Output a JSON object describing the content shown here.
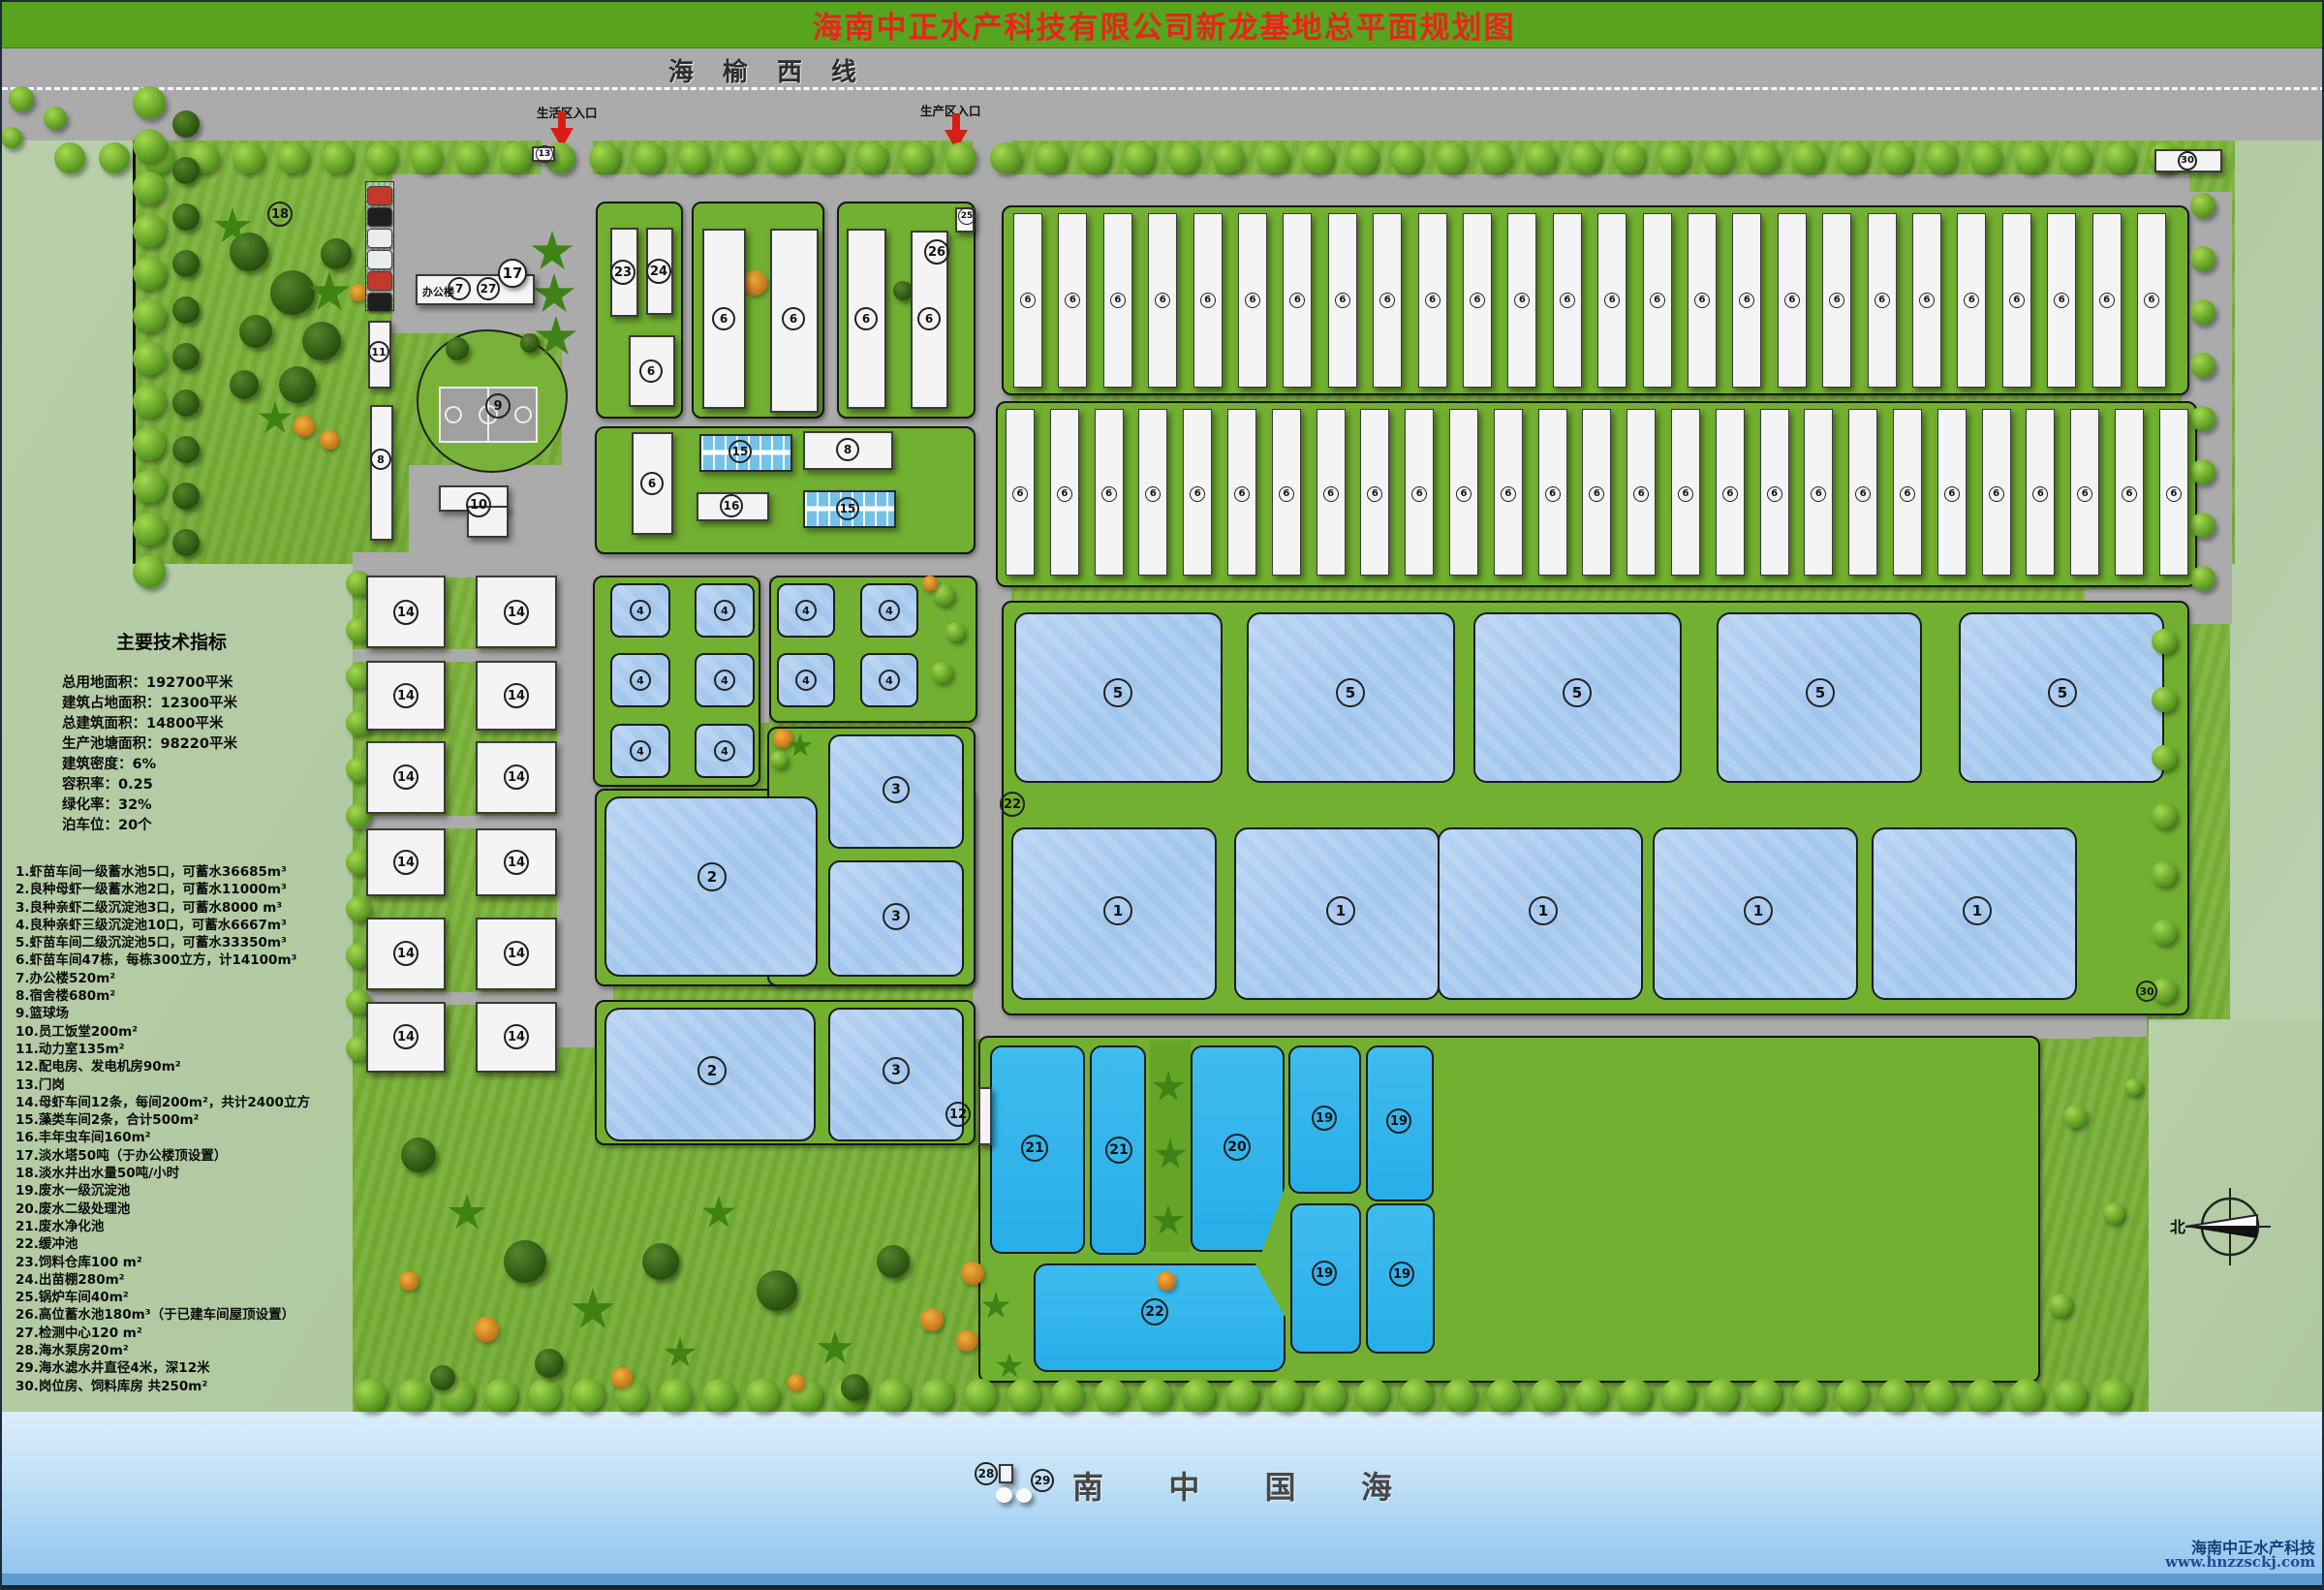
{
  "title": "海南中正水产科技有限公司新龙基地总平面规划图",
  "road_top": {
    "name": "海榆西线",
    "living_entrance": "生活区入口",
    "production_entrance": "生产区入口"
  },
  "office": {
    "label": "办公楼"
  },
  "compass": {
    "north": "北"
  },
  "sea": {
    "chars": [
      "南",
      "中",
      "国",
      "海"
    ],
    "watermark1": "海南中正水产科技",
    "watermark2": "www.hnzzsckj.com"
  },
  "tech": {
    "title": "主要技术指标",
    "lines": [
      "总用地面积：192700平米",
      "建筑占地面积：12300平米",
      "总建筑面积：14800平米",
      "生产池塘面积：98220平米",
      "建筑密度：6%",
      "容积率：0.25",
      "绿化率：32%",
      "泊车位：20个"
    ]
  },
  "legend": [
    "1.虾苗车间一级蓄水池5口，可蓄水36685m³",
    "2.良种母虾一级蓄水池2口，可蓄水11000m³",
    "3.良种亲虾二级沉淀池3口，可蓄水8000 m³",
    "4.良种亲虾三级沉淀池10口，可蓄水6667m³",
    "5.虾苗车间二级沉淀池5口，可蓄水33350m³",
    "6.虾苗车间47栋，每栋300立方，计14100m³",
    "7.办公楼520m²",
    "8.宿舍楼680m²",
    "9.篮球场",
    "10.员工饭堂200m²",
    "11.动力室135m²",
    "12.配电房、发电机房90m²",
    "13.门岗",
    "14.母虾车间12条，每间200m²，共计2400立方",
    "15.藻类车间2条，合计500m²",
    "16.丰年虫车间160m²",
    "17.淡水塔50吨（于办公楼顶设置）",
    "18.淡水井出水量50吨/小时",
    "19.废水一级沉淀池",
    "20.废水二级处理池",
    "21.废水净化池",
    "22.缓冲池",
    "23.饲料仓库100 m²",
    "24.出苗棚280m²",
    "25.锅炉车间40m²",
    "26.高位蓄水池180m³（于已建车间屋顶设置）",
    "27.检测中心120 m²",
    "28.海水泵房20m²",
    "29.海水滤水井直径4米，深12米",
    "30.岗位房、饲料库房 共250m²"
  ],
  "map": {
    "marker_fields": [
      "label",
      "x",
      "y",
      "diameter"
    ],
    "markers": [
      [
        "18",
        287,
        219,
        26
      ],
      [
        "13",
        560,
        157,
        18
      ],
      [
        "7",
        472,
        296,
        24
      ],
      [
        "27",
        502,
        296,
        24
      ],
      [
        "17",
        527,
        280,
        30
      ],
      [
        "11",
        389,
        361,
        22
      ],
      [
        "8",
        391,
        472,
        22
      ],
      [
        "9",
        512,
        417,
        26
      ],
      [
        "10",
        492,
        519,
        26
      ],
      [
        "23",
        641,
        279,
        26
      ],
      [
        "24",
        678,
        278,
        26
      ],
      [
        "6",
        670,
        381,
        24
      ],
      [
        "6",
        745,
        327,
        24
      ],
      [
        "6",
        817,
        327,
        24
      ],
      [
        "6",
        892,
        327,
        24
      ],
      [
        "6",
        957,
        327,
        24
      ],
      [
        "26",
        965,
        258,
        26
      ],
      [
        "25",
        996,
        221,
        18
      ],
      [
        "6",
        671,
        497,
        24
      ],
      [
        "15",
        762,
        464,
        24
      ],
      [
        "8",
        873,
        462,
        24
      ],
      [
        "16",
        753,
        520,
        24
      ],
      [
        "15",
        873,
        523,
        24
      ],
      [
        "14",
        417,
        630,
        26
      ],
      [
        "14",
        531,
        630,
        26
      ],
      [
        "14",
        417,
        716,
        26
      ],
      [
        "14",
        531,
        716,
        26
      ],
      [
        "14",
        417,
        800,
        26
      ],
      [
        "14",
        531,
        800,
        26
      ],
      [
        "14",
        417,
        888,
        26
      ],
      [
        "14",
        531,
        888,
        26
      ],
      [
        "14",
        417,
        982,
        26
      ],
      [
        "14",
        531,
        982,
        26
      ],
      [
        "14",
        417,
        1068,
        26
      ],
      [
        "14",
        531,
        1068,
        26
      ],
      [
        "4",
        659,
        628,
        22
      ],
      [
        "4",
        746,
        628,
        22
      ],
      [
        "4",
        659,
        700,
        22
      ],
      [
        "4",
        746,
        700,
        22
      ],
      [
        "4",
        659,
        773,
        22
      ],
      [
        "4",
        746,
        773,
        22
      ],
      [
        "4",
        830,
        628,
        22
      ],
      [
        "4",
        916,
        628,
        22
      ],
      [
        "4",
        830,
        700,
        22
      ],
      [
        "4",
        916,
        700,
        22
      ],
      [
        "3",
        923,
        813,
        28
      ],
      [
        "3",
        923,
        944,
        28
      ],
      [
        "2",
        733,
        903,
        30
      ],
      [
        "2",
        733,
        1103,
        30
      ],
      [
        "3",
        923,
        1103,
        28
      ],
      [
        "5",
        1152,
        713,
        30
      ],
      [
        "5",
        1392,
        713,
        30
      ],
      [
        "5",
        1626,
        713,
        30
      ],
      [
        "5",
        1877,
        713,
        30
      ],
      [
        "5",
        2127,
        713,
        30
      ],
      [
        "1",
        1152,
        938,
        30
      ],
      [
        "1",
        1382,
        938,
        30
      ],
      [
        "1",
        1591,
        938,
        30
      ],
      [
        "1",
        1813,
        938,
        30
      ],
      [
        "1",
        2039,
        938,
        30
      ],
      [
        "22",
        1043,
        828,
        26
      ],
      [
        "12",
        987,
        1148,
        26
      ],
      [
        "21",
        1066,
        1183,
        28
      ],
      [
        "21",
        1153,
        1185,
        28
      ],
      [
        "20",
        1275,
        1182,
        28
      ],
      [
        "19",
        1365,
        1152,
        26
      ],
      [
        "19",
        1442,
        1155,
        26
      ],
      [
        "19",
        1365,
        1312,
        26
      ],
      [
        "19",
        1445,
        1313,
        26
      ],
      [
        "22",
        1190,
        1352,
        28
      ],
      [
        "30",
        2214,
        1021,
        22
      ],
      [
        "30",
        2256,
        164,
        20
      ],
      [
        "28",
        1016,
        1519,
        24
      ],
      [
        "29",
        1074,
        1526,
        24
      ]
    ],
    "pond_fields": [
      "x",
      "y",
      "w",
      "h",
      "kind",
      "radius",
      "clip"
    ],
    "ponds": [
      [
        628,
        600,
        62,
        56,
        "light",
        10
      ],
      [
        715,
        600,
        62,
        56,
        "light",
        10
      ],
      [
        628,
        672,
        62,
        56,
        "light",
        10
      ],
      [
        715,
        672,
        62,
        56,
        "light",
        10
      ],
      [
        628,
        745,
        62,
        56,
        "light",
        10
      ],
      [
        715,
        745,
        62,
        56,
        "light",
        10
      ],
      [
        800,
        600,
        60,
        56,
        "light",
        10
      ],
      [
        886,
        600,
        60,
        56,
        "light",
        10
      ],
      [
        800,
        672,
        60,
        56,
        "light",
        10
      ],
      [
        886,
        672,
        60,
        56,
        "light",
        10
      ],
      [
        622,
        820,
        220,
        186,
        "light",
        16
      ],
      [
        853,
        756,
        140,
        118,
        "light",
        12
      ],
      [
        853,
        886,
        140,
        120,
        "light",
        12
      ],
      [
        622,
        1038,
        218,
        138,
        "light",
        16
      ],
      [
        853,
        1038,
        140,
        138,
        "light",
        12
      ],
      [
        1045,
        630,
        215,
        176,
        "light",
        14
      ],
      [
        1285,
        630,
        215,
        176,
        "light",
        14
      ],
      [
        1519,
        630,
        215,
        176,
        "light",
        14
      ],
      [
        1770,
        630,
        212,
        176,
        "light",
        14
      ],
      [
        2020,
        630,
        212,
        176,
        "light",
        14
      ],
      [
        1042,
        852,
        212,
        178,
        "light",
        14
      ],
      [
        1272,
        852,
        212,
        178,
        "light",
        14
      ],
      [
        1482,
        852,
        212,
        178,
        "light",
        14
      ],
      [
        1704,
        852,
        212,
        178,
        "light",
        14
      ],
      [
        1930,
        852,
        212,
        178,
        "light",
        14
      ],
      [
        1020,
        1077,
        98,
        215,
        "cyan",
        12
      ],
      [
        1123,
        1077,
        58,
        216,
        "cyan",
        12
      ],
      [
        1227,
        1077,
        97,
        213,
        "cyan",
        12,
        "polygon(0 0,100% 0,100% 69%,76% 100%,0 100%)"
      ],
      [
        1328,
        1077,
        75,
        153,
        "cyan",
        12
      ],
      [
        1408,
        1077,
        70,
        161,
        "cyan",
        12
      ],
      [
        1330,
        1240,
        73,
        155,
        "cyan",
        12
      ],
      [
        1408,
        1240,
        71,
        155,
        "cyan",
        12
      ],
      [
        1065,
        1302,
        260,
        112,
        "cyan",
        14,
        "polygon(0 0,88% 0,100% 50%,100% 100%,0 100%)"
      ]
    ],
    "building_fields": [
      "id",
      "x",
      "y",
      "w",
      "h",
      "kind"
    ],
    "buildings": [
      [
        "office",
        427,
        281,
        123,
        32,
        "office"
      ],
      [
        "23",
        628,
        233,
        29,
        92
      ],
      [
        "24",
        665,
        233,
        28,
        90
      ],
      [
        "6",
        647,
        344,
        48,
        74
      ],
      [
        "6",
        723,
        234,
        45,
        186
      ],
      [
        "6",
        793,
        234,
        50,
        190
      ],
      [
        "6",
        872,
        234,
        41,
        186
      ],
      [
        "6",
        938,
        236,
        39,
        184
      ],
      [
        "25",
        984,
        212,
        20,
        26
      ],
      [
        "6",
        650,
        444,
        43,
        106
      ],
      [
        "8",
        827,
        443,
        93,
        40
      ],
      [
        "16",
        717,
        506,
        75,
        30
      ],
      [
        "11",
        378,
        329,
        24,
        70
      ],
      [
        "8",
        380,
        416,
        24,
        140
      ],
      [
        "10",
        451,
        499,
        72,
        27
      ],
      [
        "10",
        480,
        520,
        43,
        33
      ],
      [
        "13",
        547,
        149,
        24,
        16
      ],
      [
        "30",
        2222,
        152,
        70,
        24
      ],
      [
        "12",
        1008,
        1120,
        14,
        60
      ],
      [
        "28",
        1029,
        1509,
        15,
        20
      ],
      [
        "14",
        376,
        592,
        82,
        75
      ],
      [
        "14",
        489,
        592,
        84,
        75
      ],
      [
        "14",
        376,
        680,
        82,
        72
      ],
      [
        "14",
        489,
        680,
        84,
        72
      ],
      [
        "14",
        376,
        763,
        82,
        75
      ],
      [
        "14",
        489,
        763,
        84,
        75
      ],
      [
        "14",
        376,
        853,
        82,
        70
      ],
      [
        "14",
        489,
        853,
        84,
        70
      ],
      [
        "14",
        376,
        945,
        82,
        75
      ],
      [
        "14",
        489,
        945,
        84,
        75
      ],
      [
        "14",
        376,
        1032,
        82,
        73
      ],
      [
        "14",
        489,
        1032,
        84,
        73
      ],
      [
        "15",
        720,
        446,
        96,
        39,
        "strip"
      ],
      [
        "15",
        827,
        504,
        96,
        39,
        "strip"
      ]
    ],
    "barracks_fields": [
      "x",
      "y",
      "count",
      "pitch",
      "barWidth",
      "barHeight",
      "labelY",
      "label"
    ],
    "barracks": [
      [
        1044,
        218,
        26,
        46.4,
        30,
        180,
        308,
        "6"
      ],
      [
        1036,
        420,
        27,
        45.8,
        30,
        172,
        508,
        "6"
      ]
    ]
  }
}
